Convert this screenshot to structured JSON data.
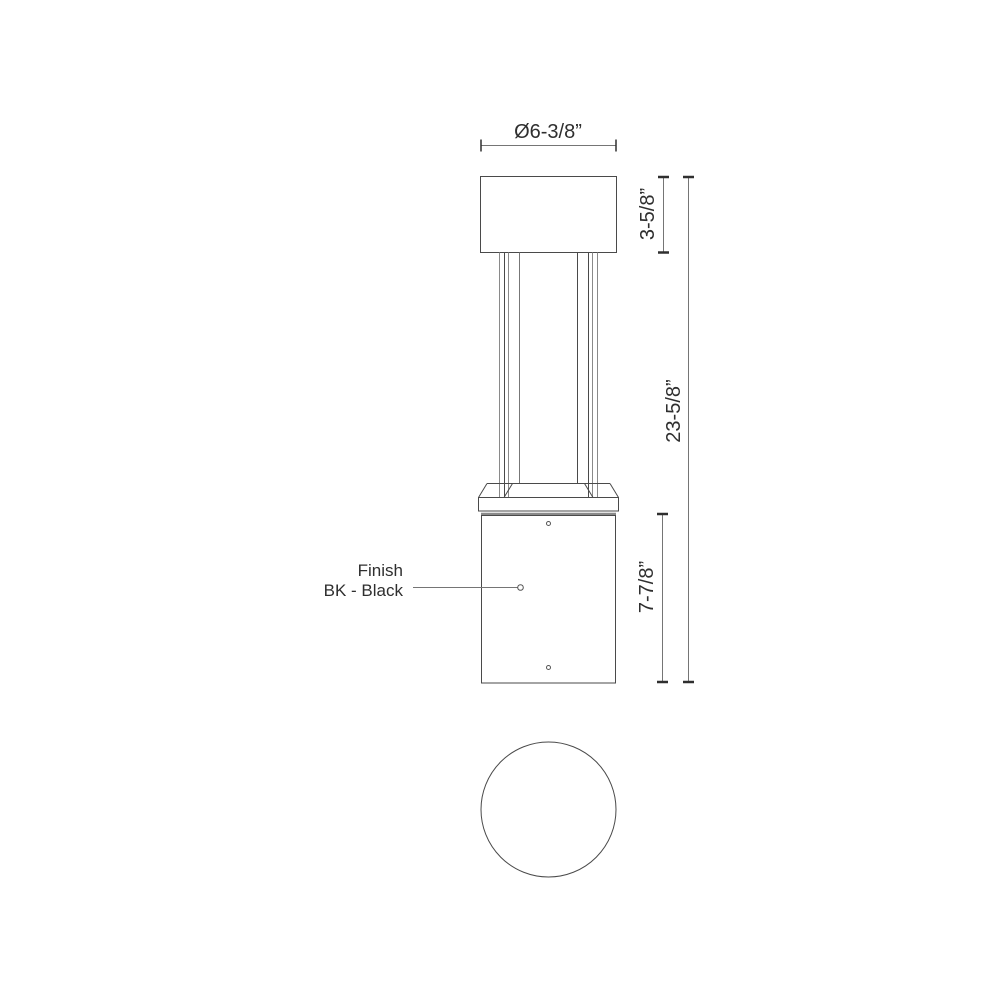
{
  "drawing": {
    "type": "bollard-light-spec-drawing",
    "views": [
      "front-elevation",
      "top-plan"
    ],
    "dim_top_diameter": "Ø6-3/8”",
    "dim_head_height": "3-5/8”",
    "dim_overall_height": "23-5/8”",
    "dim_base_height": "7-7/8”",
    "finish_line1": "Finish",
    "finish_line2": "BK - Black",
    "colors": {
      "object_line": "#4a4a4a",
      "light_line": "#8a8a8a",
      "dim_line": "#757575",
      "tick": "#2f2f2f",
      "text": "#2f2f2f",
      "background": "#ffffff"
    }
  }
}
